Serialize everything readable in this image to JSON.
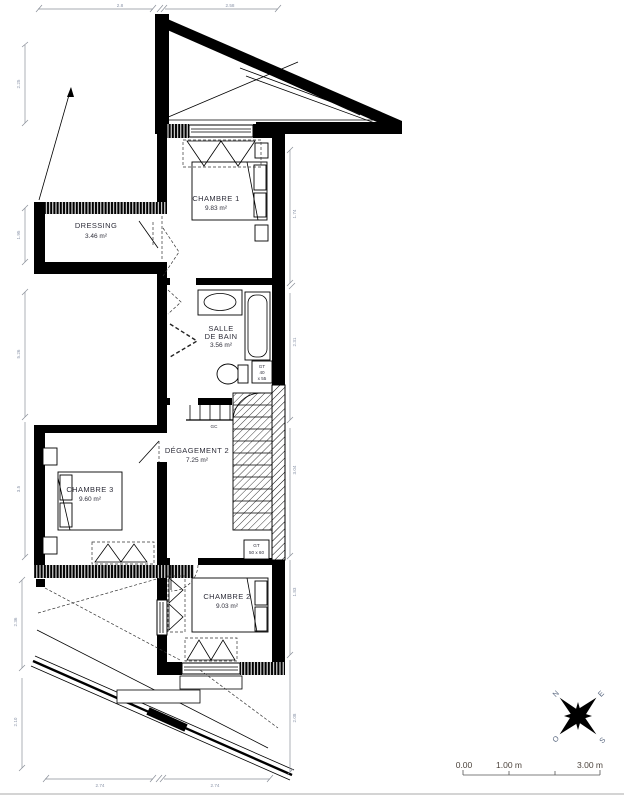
{
  "rooms": {
    "chambre1": {
      "name": "CHAMBRE 1",
      "area": "9.83 m²"
    },
    "dressing": {
      "name": "DRESSING",
      "area": "3.46 m²"
    },
    "salle_de_bain": {
      "name_line1": "SALLE",
      "name_line2": "DE BAIN",
      "area": "3.56 m²"
    },
    "degagement2": {
      "name": "DÉGAGEMENT 2",
      "area": "7.25 m²"
    },
    "chambre3": {
      "name": "CHAMBRE 3",
      "area": "9.60 m²"
    },
    "chambre2": {
      "name": "CHAMBRE 2",
      "area": "9.03 m²"
    }
  },
  "annotations": {
    "gc": "GC",
    "gt_bath": {
      "line1": "GT",
      "line2": "40",
      "line3": "x 55"
    },
    "gt_chambre2": {
      "line1": "GT",
      "line2": "50 x 60"
    }
  },
  "dimensions": {
    "top": [
      "2.8",
      "2.58"
    ],
    "bottom": [
      "2.74",
      "2.74"
    ],
    "left": [
      "2.25",
      "1.95",
      "5.26",
      "3.5",
      "2.36",
      "2.10"
    ],
    "right": [
      "1.74",
      "2.31",
      "3.04",
      "1.83",
      "2.08"
    ]
  },
  "compass": {
    "n": "N",
    "e": "E",
    "s": "S",
    "o": "O"
  },
  "scale_bar": {
    "start": "0.00",
    "mid": "1.00 m",
    "end": "3.00 m"
  },
  "colors": {
    "wall": "#000000",
    "dim_label": "#8a94a8",
    "room_label": "#2e2e3a",
    "scale_label": "#4d443d"
  }
}
